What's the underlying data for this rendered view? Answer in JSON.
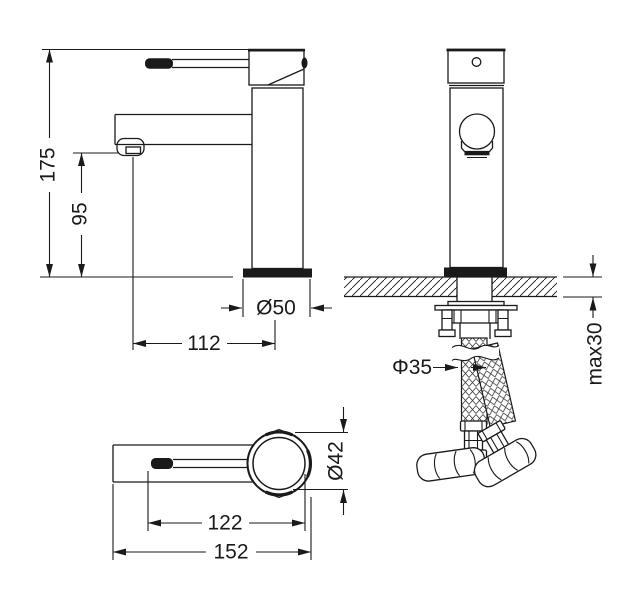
{
  "colors": {
    "ink": "#1a1a1a",
    "background": "#ffffff"
  },
  "dimensions": {
    "total_height": "175",
    "spout_height": "95",
    "base_diameter": "Ø50",
    "spout_reach": "112",
    "max_deck_thickness": "max30",
    "mounting_hole_diameter": "Φ35",
    "body_diameter": "Ø42",
    "handle_to_body": "122",
    "overall_length": "152"
  }
}
